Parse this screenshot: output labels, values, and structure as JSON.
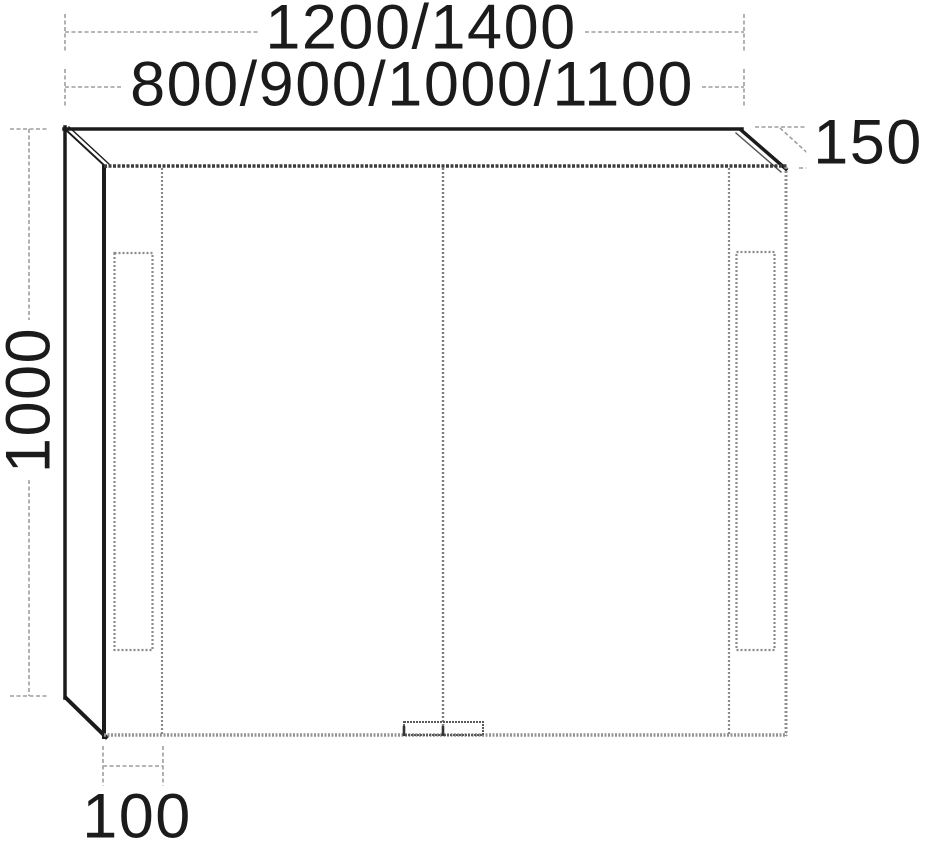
{
  "drawing": {
    "type": "technical-drawing",
    "subject": "mirror cabinet with two doors, LED light strips and handle recess, front perspective elevation",
    "dimensions": {
      "width_overall": "1200/1400",
      "width_variants": "800/900/1000/1100",
      "depth": "150",
      "height": "1000",
      "side_offset": "100"
    },
    "colors": {
      "background": "#ffffff",
      "solid_line": "#1b1b1b",
      "front_edge_dark": "#3d3d3d",
      "dotted_line": "#8a8a8a",
      "dimension_line": "#9e9e9e",
      "text": "#1b1b1b"
    }
  }
}
